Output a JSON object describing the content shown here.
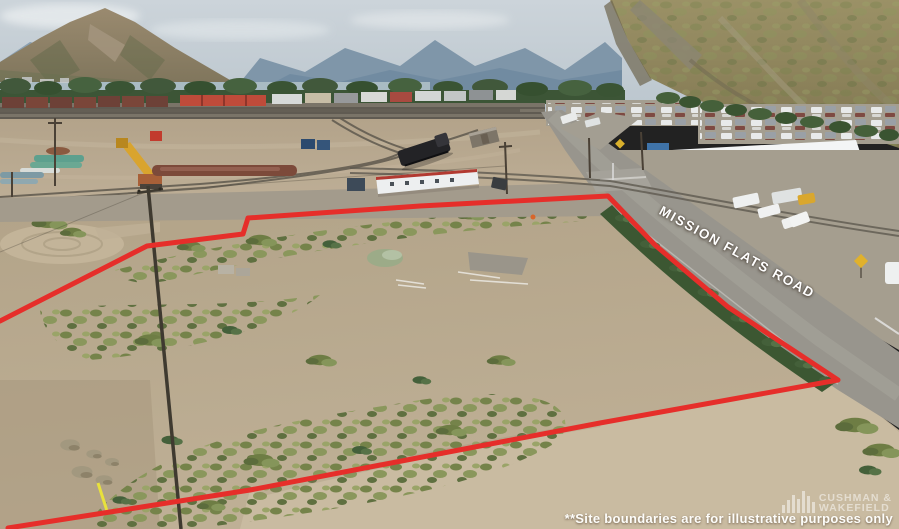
{
  "overlays": {
    "road_label": "MISSION FLATS ROAD",
    "disclaimer": "**Site boundaries are for illustrative purposes only"
  },
  "branding": {
    "line1": "CUSHMAN &",
    "line2": "WAKEFIELD",
    "icon": "building-bars-icon"
  },
  "boundary": {
    "color": "#e62e2a",
    "points": "0,321 147,246 243,234 248,218 420,206 608,196 655,245 728,307 838,380 600,423 250,490 8,528"
  },
  "colors": {
    "boundary_red": "#e62e2a",
    "label_white": "#ffffff"
  }
}
